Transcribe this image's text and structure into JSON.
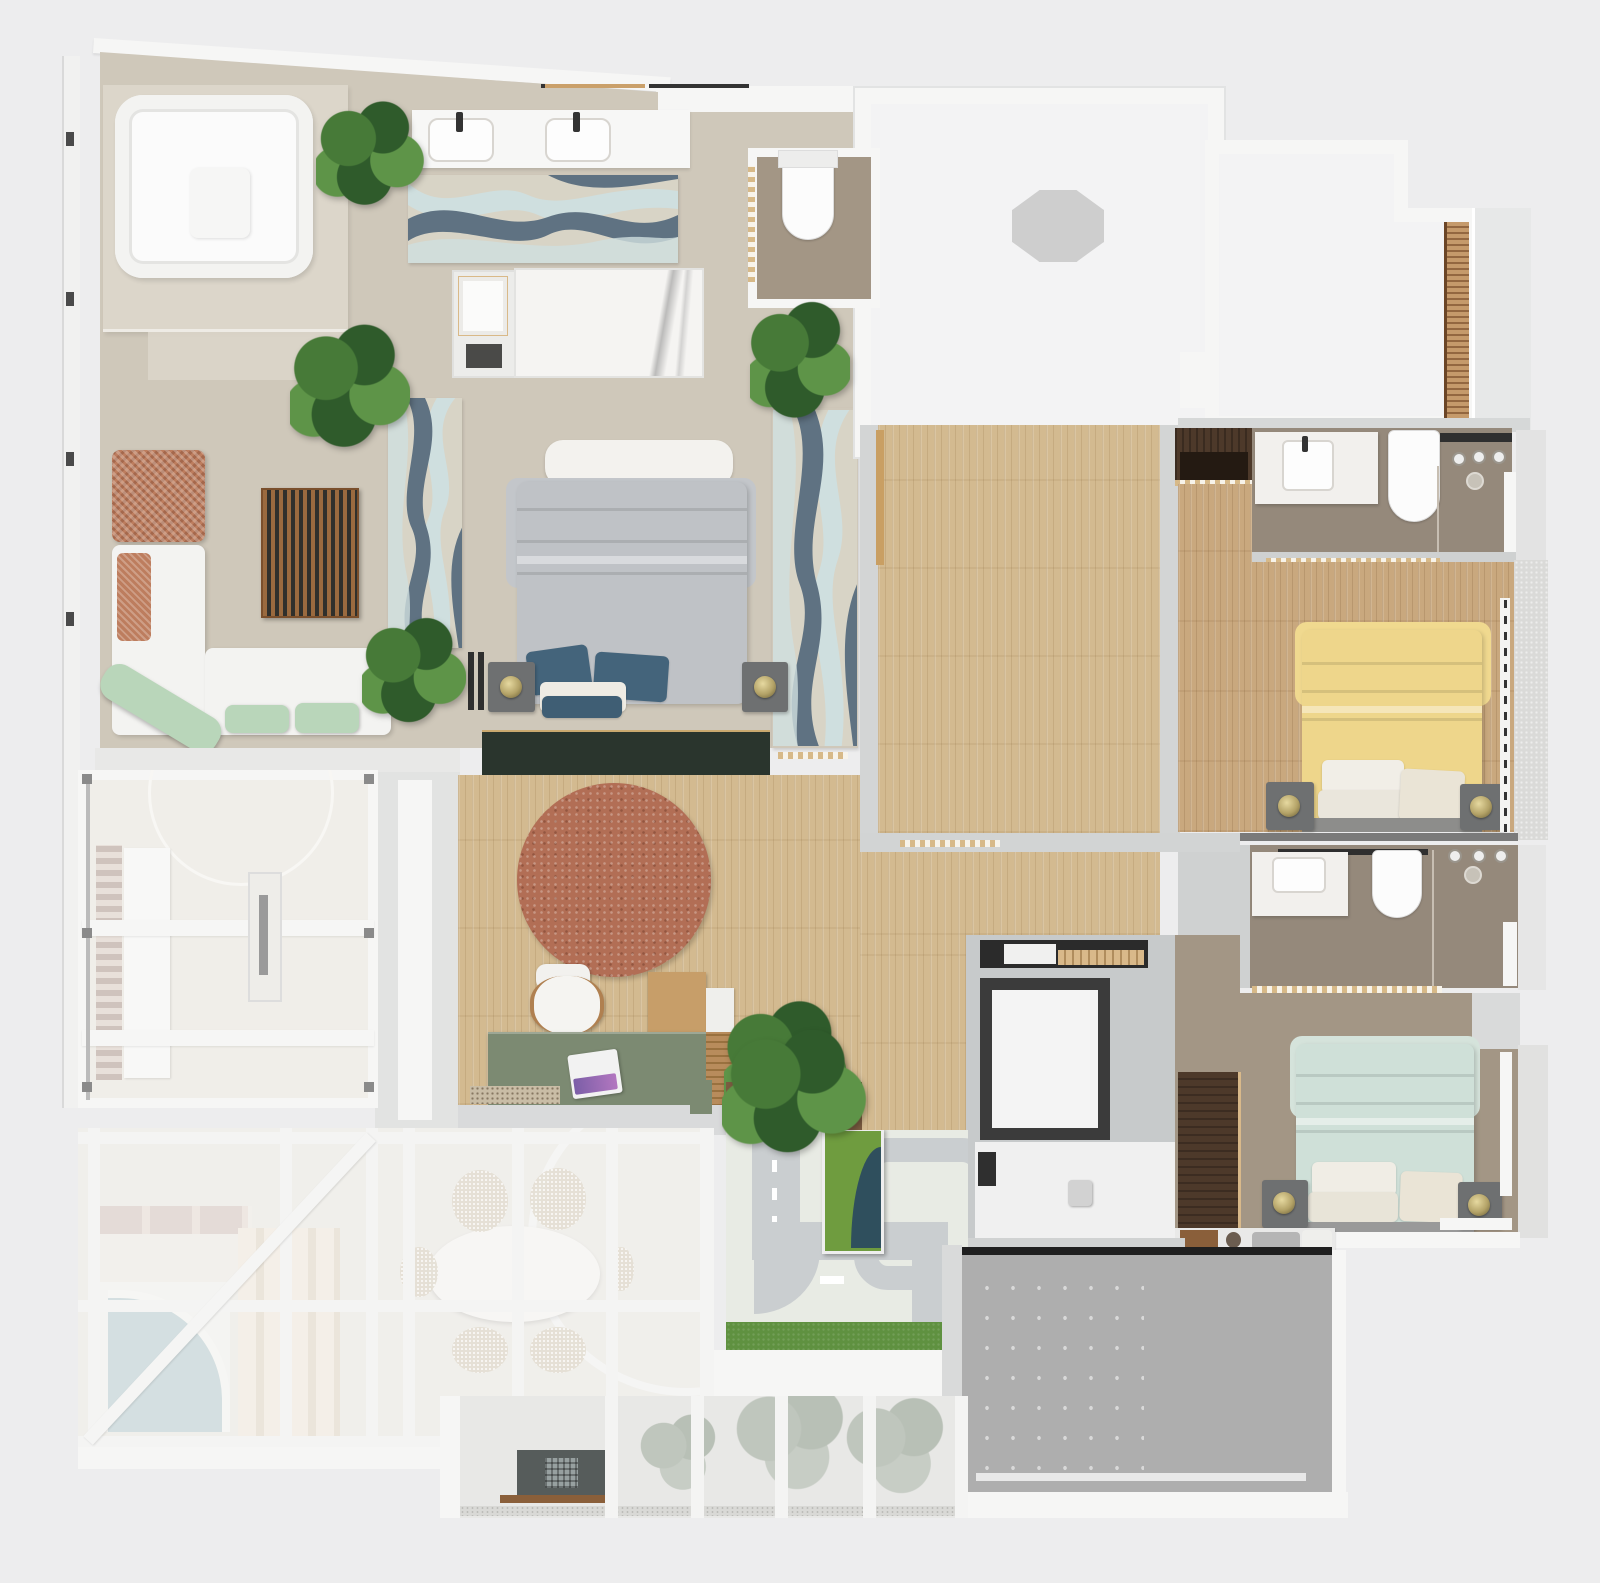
{
  "meta": {
    "type": "3d-floor-plan-top-down-render",
    "width": 1600,
    "height": 1583,
    "has_text": false
  },
  "palette": {
    "page": "#ededee",
    "slab": "#d6d8d8",
    "slab2": "#c7cacb",
    "wall": "#f6f6f5",
    "roomw": "#f3f3f4",
    "beige": "#cfc8ba",
    "platform": "#dcd6ca",
    "taupe": "#a39685",
    "taupeD": "#95897b",
    "wood": "#d3ba90",
    "woodW": "#c9a87e",
    "woodD": "#4d392a",
    "slat": "#9a6a3f",
    "rugC": "#d8d4c6",
    "rugS": "#5f7282",
    "rugI": "#cfdfdf",
    "duvG": "#bfc2c6",
    "pilB": "#44647b",
    "nstand": "#6e7071",
    "brass": "#b3a267",
    "grnW": "#2a352d",
    "sage": "#7c8a72",
    "terra": "#b26e55",
    "rust": "#bd7d5e",
    "mint": "#b9d6ba",
    "sofa": "#f3f3f1",
    "yel": "#eed68b",
    "mintB": "#cfe0d8",
    "cream": "#eae4d6",
    "marble": "#f5f4f2",
    "glass": "#eae8e3",
    "grass": "#5f9140",
    "pond": "#2f4f5d",
    "road": "#b6bcbe",
    "court": "#dfe3da",
    "patio": "#aeaeae",
    "soil": "#7b5c41",
    "treeA": "#2f5b2b",
    "treeB": "#477a38",
    "treeC": "#5e9448",
    "thresh": "#d7b988",
    "dark": "#2f2f2f",
    "brown": "#4d392a"
  },
  "rooms": [
    {
      "name": "master-suite-open-bath"
    },
    {
      "name": "master-bedroom"
    },
    {
      "name": "lounge-corner"
    },
    {
      "name": "powder-room"
    },
    {
      "name": "skylight-room-a"
    },
    {
      "name": "skylight-room-b"
    },
    {
      "name": "bathroom-1"
    },
    {
      "name": "bedroom-yellow"
    },
    {
      "name": "bathroom-2"
    },
    {
      "name": "bedroom-mint"
    },
    {
      "name": "elevator-lobby"
    },
    {
      "name": "office-studio"
    },
    {
      "name": "empty-wood-room"
    },
    {
      "name": "courtyard-playground"
    },
    {
      "name": "glass-roof-atrium"
    },
    {
      "name": "dining-below-glass"
    },
    {
      "name": "roof-terrace"
    },
    {
      "name": "lower-patio"
    }
  ],
  "furniture": [
    "square-jacuzzi",
    "double-vanity",
    "wavy-rug",
    "marble-shower-slab",
    "master-bed",
    "bedside-tables",
    "brass-lamps",
    "rust-ottoman",
    "l-shaped-sofa",
    "mint-loungers",
    "slatted-wood-bench",
    "dark-green-wardrobe",
    "round-terracotta-rug",
    "desk-with-chair",
    "sage-work-table",
    "laptop",
    "wall-hung-toilets",
    "walk-in-showers",
    "yellow-double-bed",
    "mint-double-bed",
    "dark-wood-wardrobes",
    "elevator-cab",
    "oval-dining-table",
    "dining-chairs",
    "staircase",
    "arched-blue-rug",
    "planter-with-pond",
    "toy-road-play-mat",
    "trees",
    "skylight-octagon"
  ]
}
